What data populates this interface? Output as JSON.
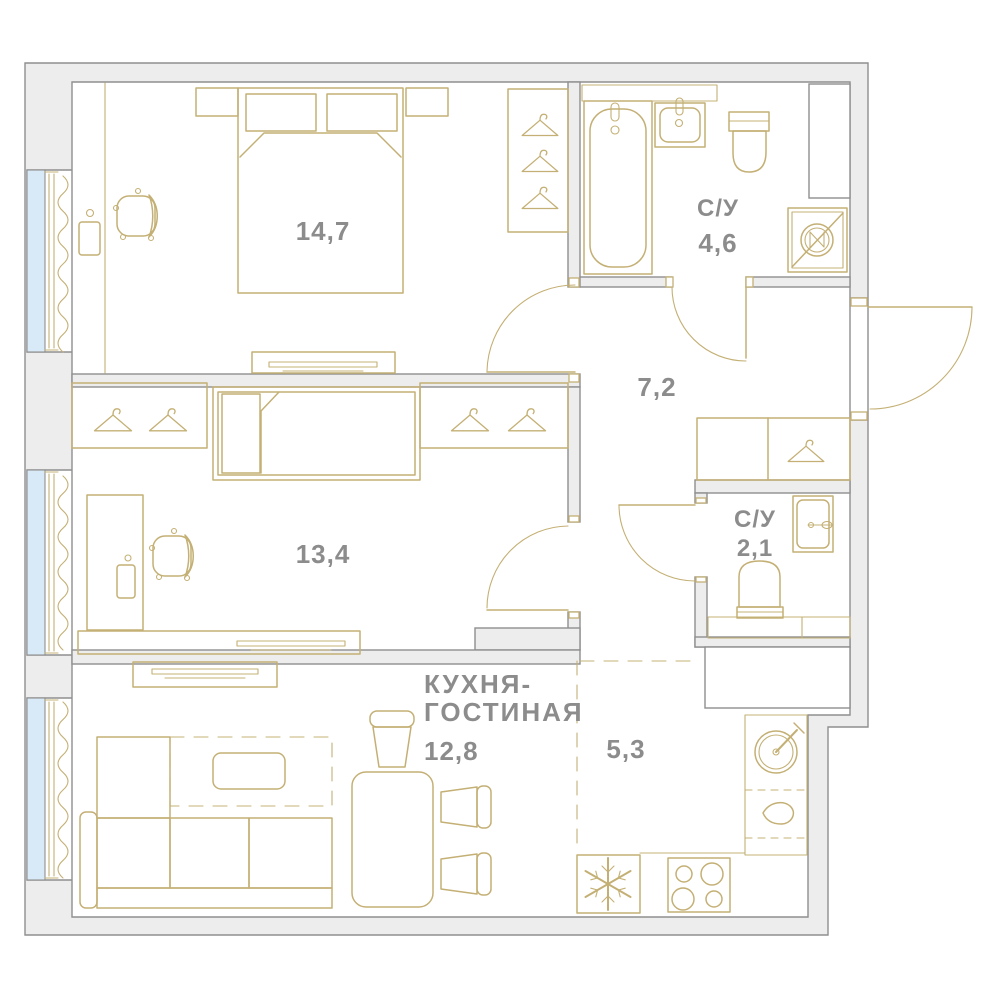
{
  "plan": {
    "title": "apartment-floor-plan",
    "colors": {
      "background": "#ffffff",
      "wall_fill": "#ededed",
      "wall_stroke": "#8f8f8f",
      "furniture": "#c4b075",
      "window_fill": "#d8e9f8",
      "label": "#8c8c8c"
    },
    "labels": {
      "bedroom1_area": "14,7",
      "bedroom2_area": "13,4",
      "hall_area": "7,2",
      "bath1_name": "С/У",
      "bath1_area": "4,6",
      "bath2_name": "С/У",
      "bath2_area": "2,1",
      "kitchen_name_line1": "КУХНЯ-",
      "kitchen_name_line2": "ГОСТИНАЯ",
      "kitchen_area": "12,8",
      "kitchen_zone_area": "5,3"
    },
    "icons": {
      "washing_machine": "circle-with-slash",
      "fridge": "snowflake",
      "stove": "four-burners",
      "kitchen_sink": "round-basin-with-tap",
      "wardrobe": "clothes-hanger",
      "window": "blue-strip",
      "curtain": "wavy-line"
    }
  }
}
